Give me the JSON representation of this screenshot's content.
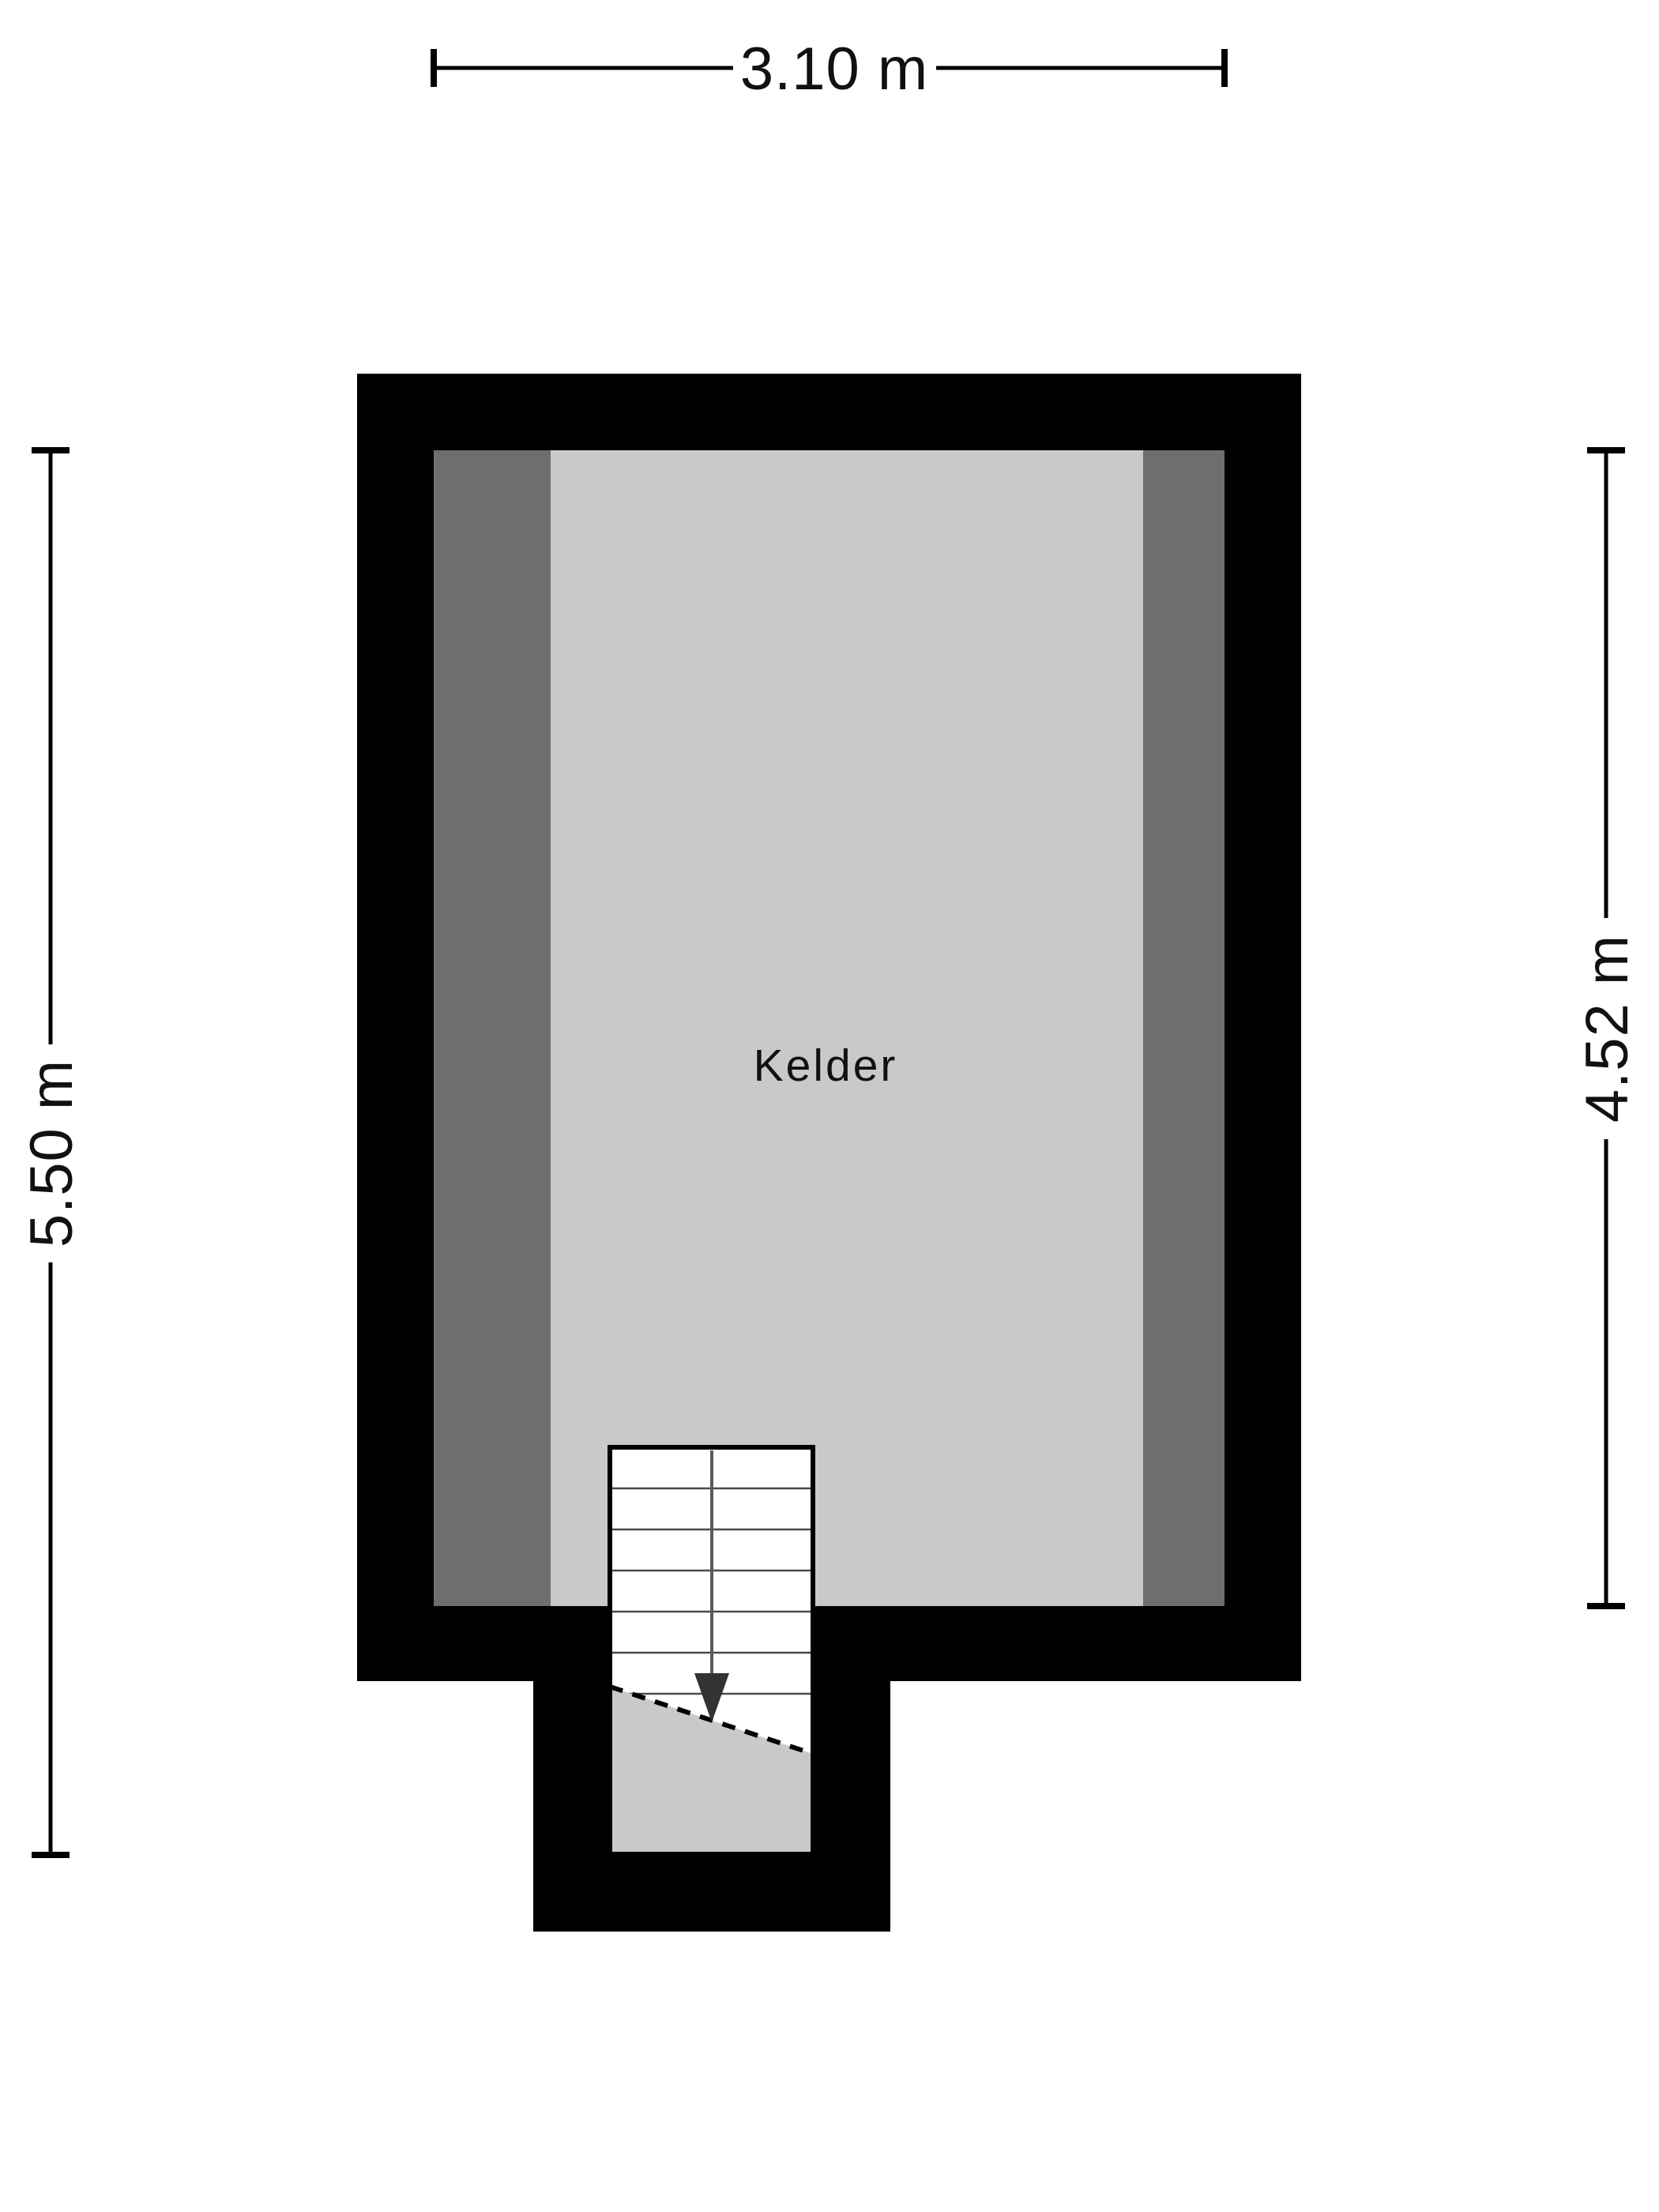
{
  "floor_plan": {
    "room_label": "Kelder",
    "dimensions": {
      "top": "3.10 m",
      "left": "5.50 m",
      "right": "4.52 m"
    },
    "colors": {
      "background": "#ffffff",
      "wall": "#000000",
      "inner_wall_strip": "#6e6e6e",
      "floor": "#c9c9c9",
      "stair_white": "#ffffff",
      "stair_lower_landing": "#c9c9c9",
      "tread_line": "#4a4a4a",
      "arrow": "#333333",
      "dimension_line": "#000000"
    },
    "stairs": {
      "direction": "down",
      "tread_count": 6
    }
  }
}
